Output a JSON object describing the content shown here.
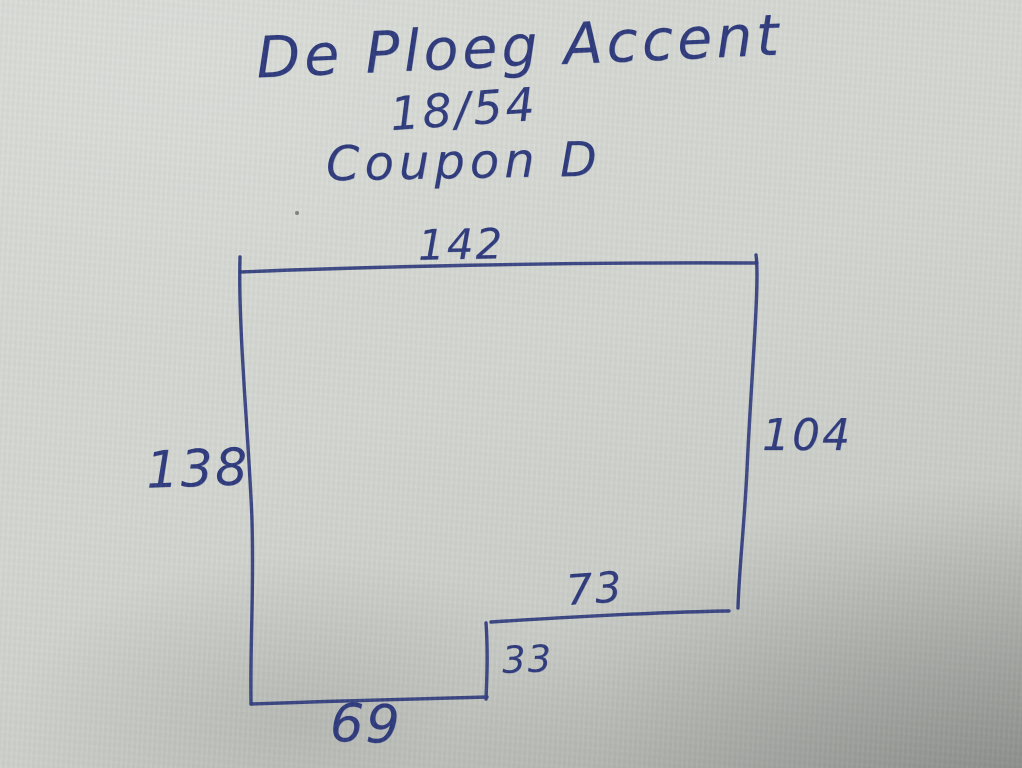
{
  "photo": {
    "paper_color": "#d3d6d1",
    "ink_color": "#2f3b7e"
  },
  "title": {
    "line1": "De Ploeg Accent",
    "line2": "18/54",
    "line3": "Coupon D"
  },
  "diagram": {
    "shape": "rectangle-with-bottom-right-notch",
    "dimensions": {
      "top": "142",
      "right": "104",
      "left": "138",
      "step": "73",
      "notch": "33",
      "bottom": "69"
    }
  }
}
